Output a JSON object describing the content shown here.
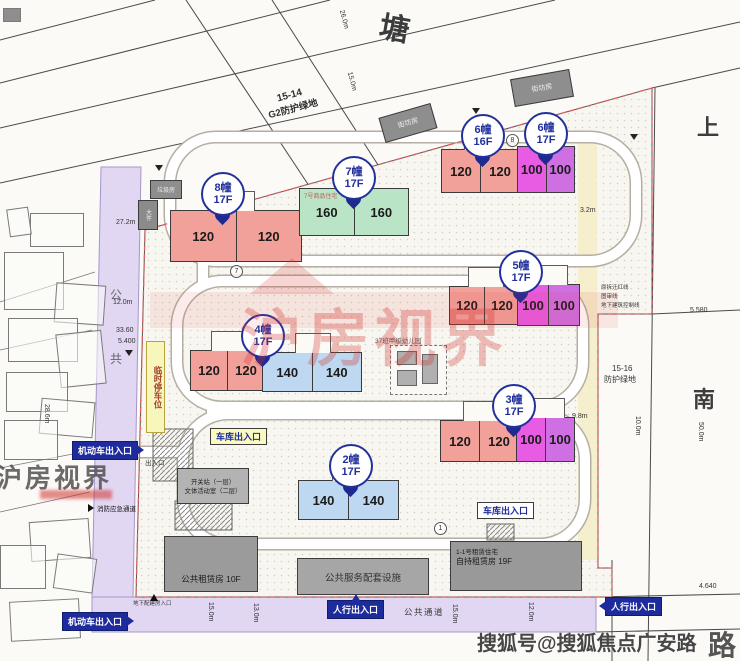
{
  "streets": {
    "top": "塘",
    "right_top": "上",
    "right_mid": "南",
    "right_bottom": "路"
  },
  "green_belts": {
    "g2_line1": "15-14",
    "g2_line2": "G2防护绿地",
    "g16_line1": "15-16",
    "g16_line2": "防护绿地"
  },
  "boundary_notes": [
    "原拆迁红线",
    "图审线",
    "地下建筑控制线"
  ],
  "balloons": [
    {
      "num": "8幢",
      "floors": "17F"
    },
    {
      "num": "7幢",
      "floors": "17F"
    },
    {
      "num": "6幢",
      "floors": "16F"
    },
    {
      "num": "6幢",
      "floors": "17F"
    },
    {
      "num": "5幢",
      "floors": "17F"
    },
    {
      "num": "4幢",
      "floors": "17F"
    },
    {
      "num": "3幢",
      "floors": "17F"
    },
    {
      "num": "2幢",
      "floors": "17F"
    }
  ],
  "clusters": {
    "b8": {
      "units": [
        "120",
        "120"
      ]
    },
    "b7": {
      "units": [
        "160",
        "160"
      ],
      "note": "7号商品住宅"
    },
    "b6a": {
      "units": [
        "120",
        "120"
      ]
    },
    "b6b": {
      "units": [
        "100",
        "100"
      ]
    },
    "b5a": {
      "units": [
        "120",
        "120"
      ]
    },
    "b5b": {
      "units": [
        "100",
        "100"
      ]
    },
    "b4a": {
      "units": [
        "120",
        "120"
      ]
    },
    "b4b": {
      "units": [
        "140",
        "140"
      ]
    },
    "b3a": {
      "units": [
        "120",
        "120"
      ]
    },
    "b3b": {
      "units": [
        "100",
        "100"
      ]
    },
    "b2": {
      "units": [
        "140",
        "140"
      ]
    }
  },
  "facilities": {
    "public_rental": "公共租赁房 10F",
    "service": "公共服务配套设施",
    "rental19_line1": "1-1号租赁住宅",
    "rental19_line2": "自持租赁房 19F",
    "switch_line1": "开关站（一层）",
    "switch_line2": "文体活动室（二层）",
    "kindergarten": "37班甲级幼儿园",
    "shop1": "街坊房",
    "shop2": "街坊房",
    "trash": "垃圾房",
    "bulky": "大件"
  },
  "entrances": {
    "vehicle": "机动车出入口",
    "pedestrian": "人行出入口",
    "garage": "车库出入口",
    "fire": "消防应急通道",
    "basement": "地下配建房入口",
    "exit_note": "出入口"
  },
  "road_labels": {
    "public_passage": "公共通道",
    "temp_parking": "临时停车位",
    "char1": "公",
    "char2": "共"
  },
  "dimensions": [
    "27.2m",
    "12.0m",
    "33.60",
    "28.6m",
    "26.0m",
    "15.0m",
    "10.0m",
    "50.0m",
    "5.580",
    "4.640",
    "15.0m",
    "13.0m",
    "15.0m",
    "12.0m",
    "9.8m",
    "3.2m",
    "5.400"
  ],
  "markers": [
    "7",
    "1",
    "8"
  ],
  "watermarks": {
    "center": "沪房视界",
    "left": "沪房视界",
    "bottom_right": "搜狐号@搜狐焦点广安路"
  },
  "colors": {
    "unit120": "#f1a19a",
    "unit140": "#bdd8f0",
    "unit160": "#b9e4c5",
    "unit100": "#e75ce3",
    "marker_navy": "#1d2a8f",
    "road_purple": "#e2d7f2",
    "label_yellow": "#fafac0",
    "boundary_red": "#e06060"
  }
}
